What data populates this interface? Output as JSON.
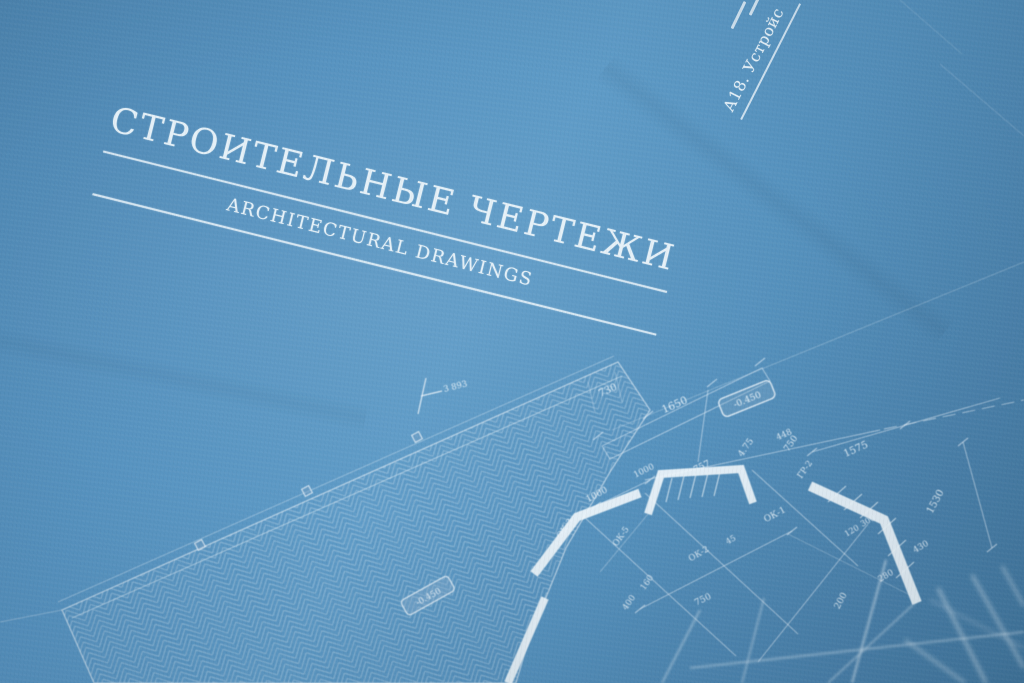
{
  "colors": {
    "paper": "#5692bf",
    "paper_light": "#5e9bc7",
    "paper_dark": "#43789f",
    "ink": "#ebf4fa"
  },
  "masthead": {
    "title": "СТРОИТЕЛЬНЫЕ ЧЕРТЕЖИ",
    "subtitle": "ARCHITECTURAL DRAWINGS"
  },
  "corner_note": {
    "text": "А18. Устройс"
  },
  "plan": {
    "spot_elevation": "3 893",
    "badges": [
      {
        "text": "-0.450"
      },
      {
        "text": "-0.450"
      }
    ],
    "labels": [
      {
        "t": "730"
      },
      {
        "t": "1650"
      },
      {
        "t": "757"
      },
      {
        "t": "4.75"
      },
      {
        "t": "750"
      },
      {
        "t": "ГР-2"
      },
      {
        "t": "448"
      },
      {
        "t": "1575"
      },
      {
        "t": "1530"
      },
      {
        "t": "1000"
      },
      {
        "t": "ОК-3"
      },
      {
        "t": "ОК-5"
      },
      {
        "t": "ОК-1"
      },
      {
        "t": "45"
      },
      {
        "t": "160"
      },
      {
        "t": "400"
      },
      {
        "t": "750"
      },
      {
        "t": "200"
      },
      {
        "t": "280"
      },
      {
        "t": "430"
      },
      {
        "t": "120"
      },
      {
        "t": "300"
      },
      {
        "t": "ОК-2"
      },
      {
        "t": "1000"
      }
    ]
  }
}
